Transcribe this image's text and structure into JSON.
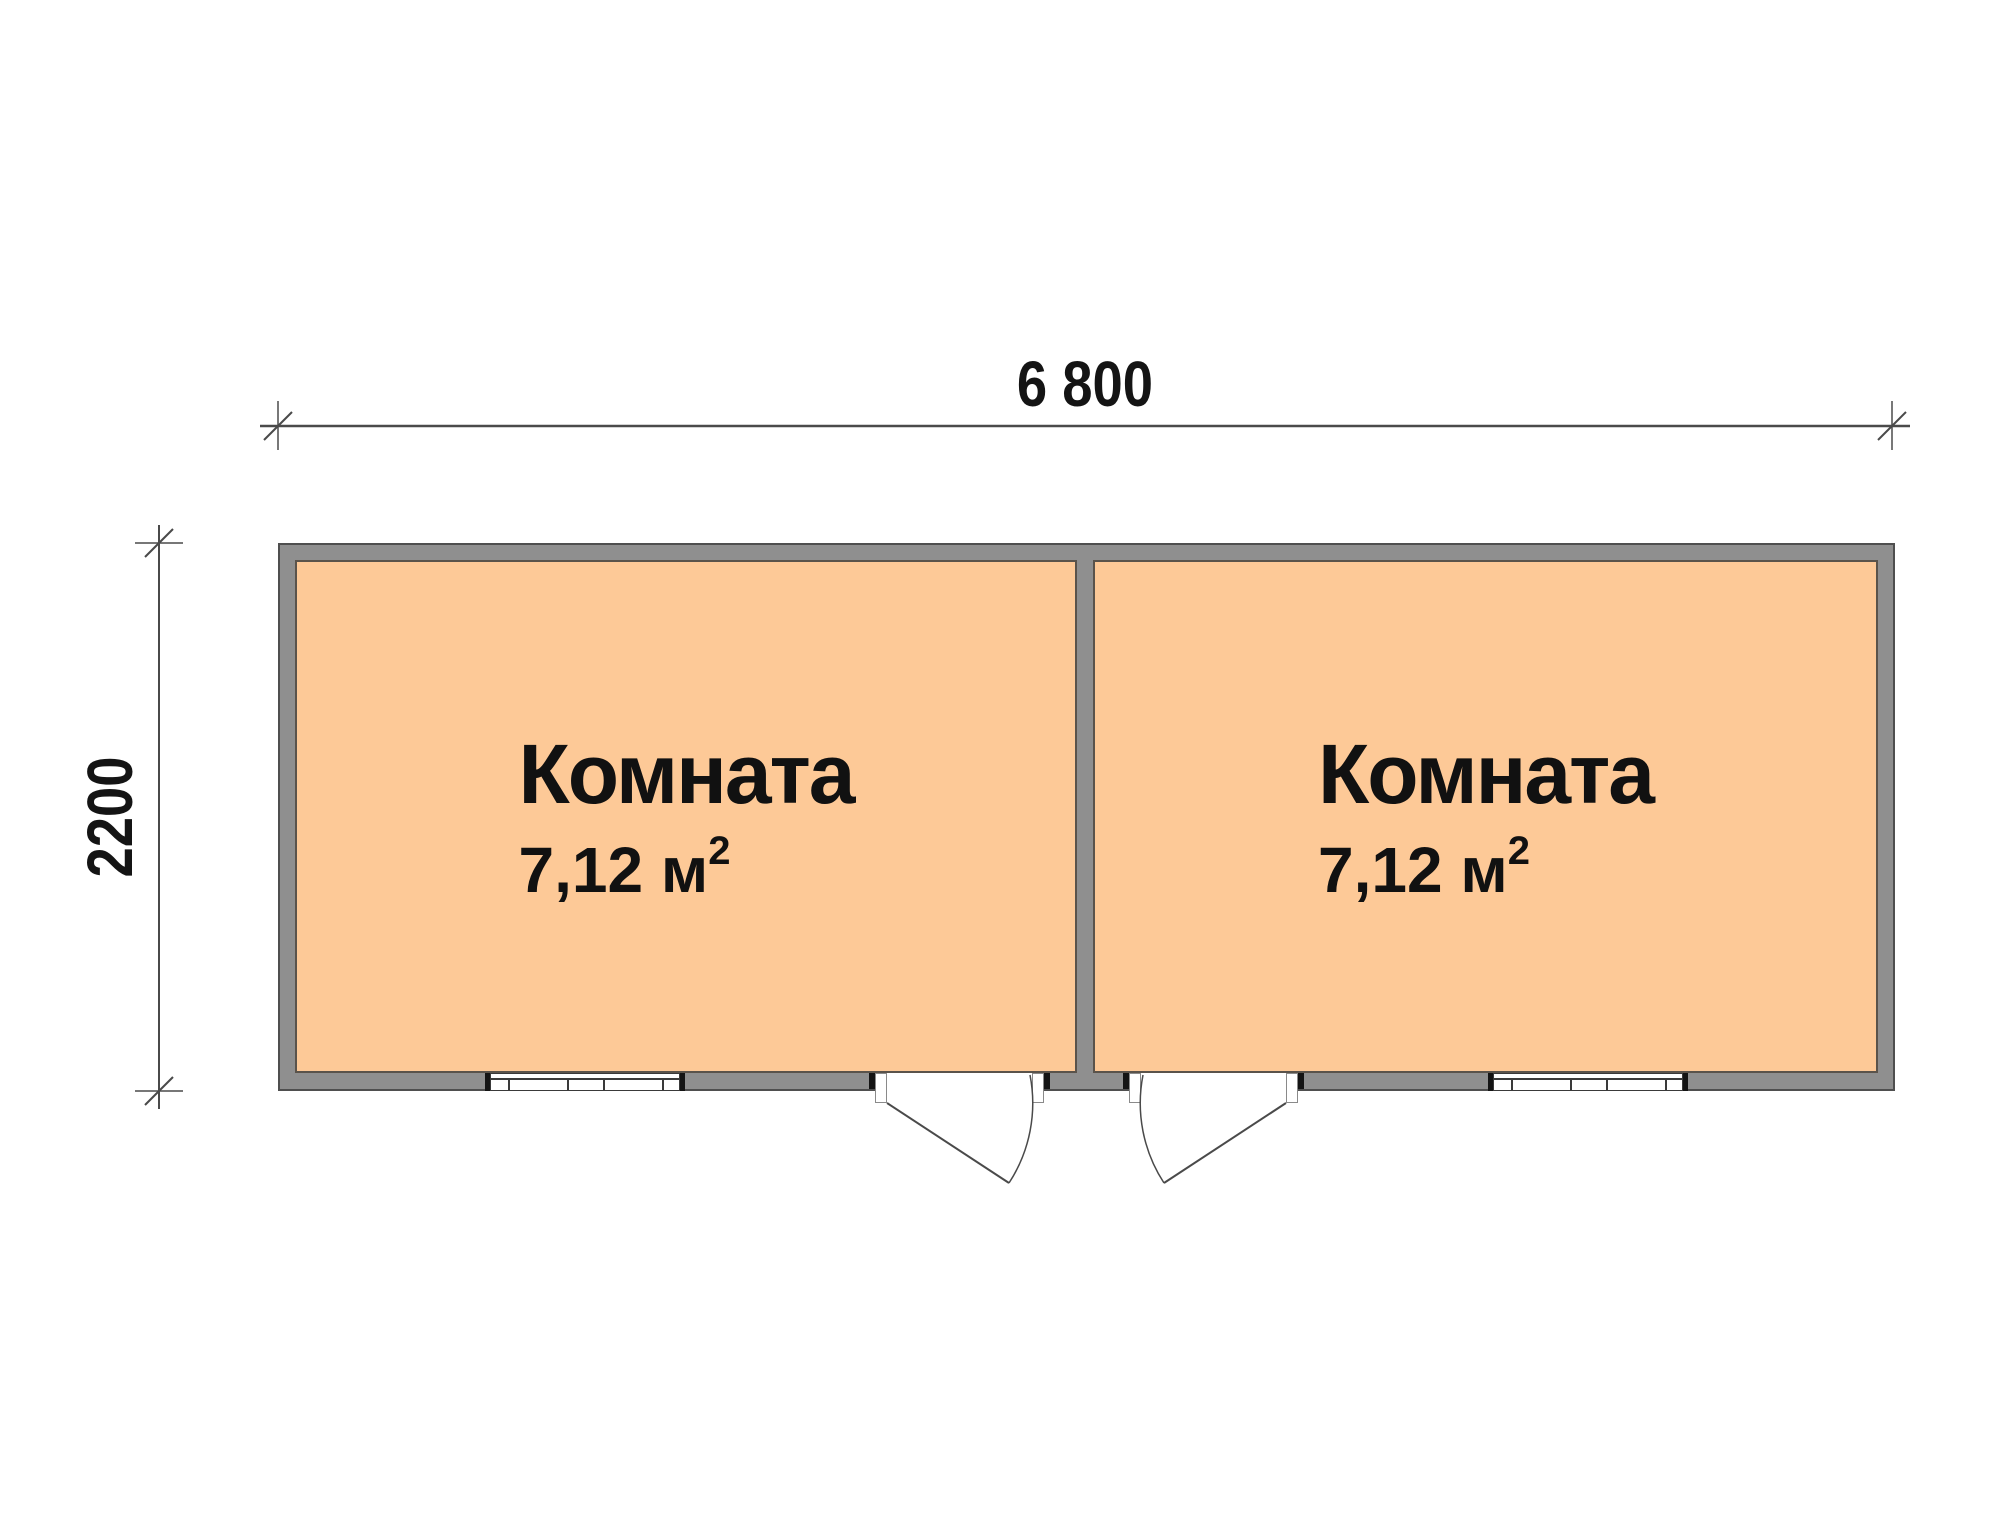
{
  "plan": {
    "dimension_width": {
      "label": "6 800"
    },
    "dimension_height": {
      "label": "2200"
    },
    "rooms": [
      {
        "name": "Комната",
        "area_text": "7,12 м",
        "area_exponent": "2"
      },
      {
        "name": "Комната",
        "area_text": "7,12 м",
        "area_exponent": "2"
      }
    ],
    "colors": {
      "room_fill": "#fdc997",
      "wall_fill": "#8f8f8f",
      "outline": "#4f4f4f",
      "drawing_line": "#4a4a4a",
      "text": "#141414"
    }
  }
}
